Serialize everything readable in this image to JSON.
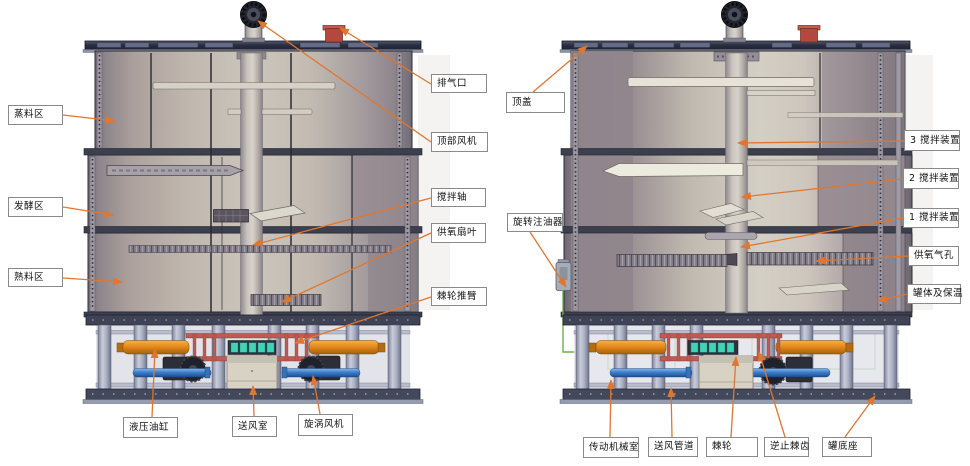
{
  "colors": {
    "leader_line": "#e0762f",
    "label_border": "#8a8a8a",
    "label_bg": "#ffffff",
    "label_text": "#111111",
    "deck_navy": "#2a2e40",
    "tank_wall": "#ccc5bb",
    "hydraulic_orange": "#e68a1c",
    "pipe_blue": "#3c7ecb",
    "pipe_green": "#6fb14c",
    "rail_red": "#c05a53",
    "exhaust_red": "#b4483e",
    "ratchet_teal": "#41d3b6"
  },
  "labels": [
    {
      "id": "steam-zone",
      "text": "蒸料区",
      "x": 8,
      "y": 105,
      "w": 55,
      "h": 20,
      "sx": 63,
      "sy": 115,
      "tx": 115,
      "ty": 121
    },
    {
      "id": "fermentation-zone",
      "text": "发酵区",
      "x": 8,
      "y": 197,
      "w": 55,
      "h": 20,
      "sx": 63,
      "sy": 207,
      "tx": 113,
      "ty": 215
    },
    {
      "id": "cooked-zone",
      "text": "熟料区",
      "x": 8,
      "y": 268,
      "w": 55,
      "h": 19,
      "sx": 63,
      "sy": 278,
      "tx": 122,
      "ty": 282
    },
    {
      "id": "exhaust-outlet",
      "text": "排气口",
      "x": 431,
      "y": 74,
      "w": 56,
      "h": 19,
      "sx": 431,
      "sy": 84,
      "tx": 340,
      "ty": 28
    },
    {
      "id": "top-fan",
      "text": "顶部风机",
      "x": 431,
      "y": 132,
      "w": 57,
      "h": 20,
      "sx": 431,
      "sy": 142,
      "tx": 258,
      "ty": 21
    },
    {
      "id": "agitator-shaft",
      "text": "搅拌轴",
      "x": 431,
      "y": 188,
      "w": 55,
      "h": 19,
      "sx": 431,
      "sy": 198,
      "tx": 253,
      "ty": 245
    },
    {
      "id": "oxygen-fan-blade",
      "text": "供氧扇叶",
      "x": 431,
      "y": 223,
      "w": 55,
      "h": 20,
      "sx": 431,
      "sy": 233,
      "tx": 282,
      "ty": 302
    },
    {
      "id": "ratchet-push-arm",
      "text": "棘轮推臂",
      "x": 431,
      "y": 287,
      "w": 56,
      "h": 19,
      "sx": 431,
      "sy": 297,
      "tx": 295,
      "ty": 343
    },
    {
      "id": "top-cover",
      "text": "顶盖",
      "x": 506,
      "y": 92,
      "w": 59,
      "h": 21,
      "sx": 533,
      "sy": 92,
      "tx": 587,
      "ty": 46
    },
    {
      "id": "rotary-oiler",
      "text": "旋转注油器",
      "x": 507,
      "y": 213,
      "w": 56,
      "h": 19,
      "sx": 530,
      "sy": 232,
      "tx": 566,
      "ty": 287
    },
    {
      "id": "agitator-3",
      "text": "3 搅拌装置",
      "x": 904,
      "y": 130,
      "w": 56,
      "h": 21,
      "sx": 904,
      "sy": 141,
      "tx": 738,
      "ty": 143
    },
    {
      "id": "agitator-2",
      "text": "2 搅拌装置",
      "x": 903,
      "y": 168,
      "w": 56,
      "h": 21,
      "sx": 903,
      "sy": 179,
      "tx": 742,
      "ty": 197
    },
    {
      "id": "agitator-1",
      "text": "1 搅拌装置",
      "x": 903,
      "y": 208,
      "w": 56,
      "h": 20,
      "sx": 903,
      "sy": 218,
      "tx": 741,
      "ty": 247
    },
    {
      "id": "oxygen-air-holes",
      "text": "供氧气孔",
      "x": 908,
      "y": 246,
      "w": 51,
      "h": 20,
      "sx": 908,
      "sy": 256,
      "tx": 816,
      "ty": 261
    },
    {
      "id": "tank-body-insulation",
      "text": "罐体及保温",
      "x": 907,
      "y": 284,
      "w": 54,
      "h": 20,
      "sx": 907,
      "sy": 294,
      "tx": 878,
      "ty": 301
    },
    {
      "id": "hydraulic-cylinder",
      "text": "液压油缸",
      "x": 123,
      "y": 417,
      "w": 55,
      "h": 21,
      "sx": 152,
      "sy": 417,
      "tx": 155,
      "ty": 349
    },
    {
      "id": "air-supply-chamber",
      "text": "送风室",
      "x": 232,
      "y": 416,
      "w": 45,
      "h": 21,
      "sx": 254,
      "sy": 416,
      "tx": 253,
      "ty": 386
    },
    {
      "id": "vortex-fan",
      "text": "旋涡风机",
      "x": 298,
      "y": 414,
      "w": 55,
      "h": 22,
      "sx": 320,
      "sy": 414,
      "tx": 313,
      "ty": 376
    },
    {
      "id": "transmission-room",
      "text": "传动机械室",
      "x": 583,
      "y": 437,
      "w": 56,
      "h": 21,
      "sx": 610,
      "sy": 437,
      "tx": 611,
      "ty": 380
    },
    {
      "id": "air-supply-duct",
      "text": "送风管道",
      "x": 648,
      "y": 437,
      "w": 50,
      "h": 20,
      "sx": 672,
      "sy": 437,
      "tx": 671,
      "ty": 388
    },
    {
      "id": "ratchet",
      "text": "棘轮",
      "x": 706,
      "y": 437,
      "w": 52,
      "h": 20,
      "sx": 731,
      "sy": 437,
      "tx": 736,
      "ty": 357
    },
    {
      "id": "anti-reverse-pawl",
      "text": "逆止棘齿",
      "x": 764,
      "y": 437,
      "w": 45,
      "h": 20,
      "sx": 785,
      "sy": 437,
      "tx": 759,
      "ty": 352
    },
    {
      "id": "tank-base",
      "text": "罐底座",
      "x": 822,
      "y": 437,
      "w": 50,
      "h": 20,
      "sx": 845,
      "sy": 437,
      "tx": 875,
      "ty": 396
    }
  ]
}
